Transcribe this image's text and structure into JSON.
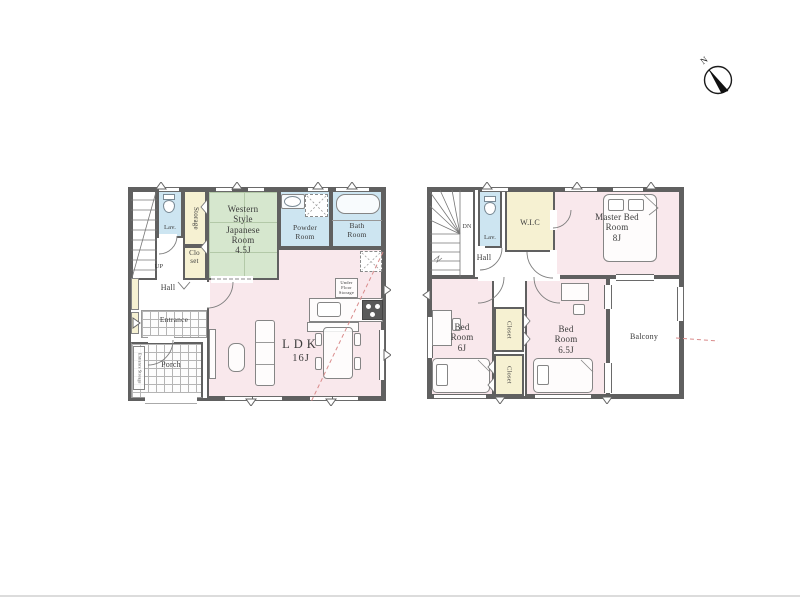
{
  "palette": {
    "wall": "#606060",
    "room_pink": "#f9e8ec",
    "room_green": "#d6e7ce",
    "room_blue": "#cde5f1",
    "room_cream": "#f6f1d2",
    "section_line": "#d98b8b"
  },
  "compass": {
    "north_label": "N"
  },
  "floor1": {
    "stairs_label": "UP",
    "lavatory_label": "Lav.",
    "storage_label": "Storage",
    "closet_label": "Closet",
    "japanese_room_name": "Western Style Japanese Room",
    "japanese_room_size": "4.5J",
    "powder_room_label": "Powder Room",
    "bath_room_label": "Bath Room",
    "hall_label": "Hall",
    "entrance_label": "Entrance",
    "entrance_storage_label": "Entrance Storage",
    "porch_label": "Porch",
    "ldk_name": "LDK",
    "ldk_size": "16J",
    "under_floor_storage_label": "Under Floor Storage"
  },
  "floor2": {
    "stairs_label": "DN",
    "lavatory_label": "Lav.",
    "wic_label": "W.I.C",
    "hall_label": "Hall",
    "master_bedroom_name": "Master Bed Room",
    "master_bedroom_size": "8J",
    "bedroom_a_name": "Bed Room",
    "bedroom_a_size": "6J",
    "bedroom_b_name": "Bed Room",
    "bedroom_b_size": "6.5J",
    "closet_a_label": "Closet",
    "closet_b_label": "Closet",
    "balcony_label": "Balcony"
  }
}
